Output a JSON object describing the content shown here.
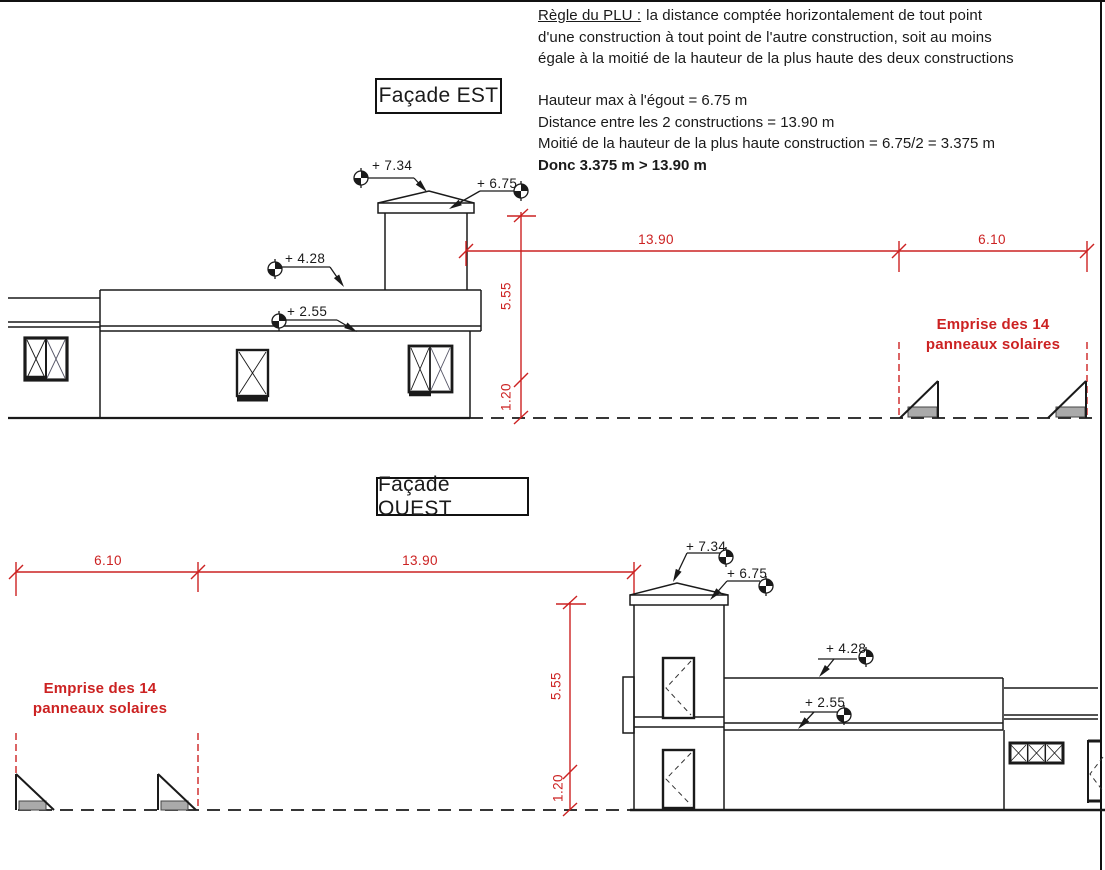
{
  "note": {
    "heading": "Règle du PLU :",
    "para_line1": "la distance comptée horizontalement de tout point",
    "para_line2": "d'une construction à tout point de l'autre construction, soit au moins",
    "para_line3": "égale à la moitié de la hauteur de la plus haute des deux constructions",
    "stat_line1": "Hauteur max à l'égout = 6.75 m",
    "stat_line2": "Distance entre les 2 constructions = 13.90 m",
    "stat_line3": "Moitié de la hauteur de la plus haute construction = 6.75/2 = 3.375 m",
    "conclusion": "Donc 3.375 m > 13.90 m"
  },
  "facade_est": {
    "title": "Façade EST",
    "level_734": "+ 7.34",
    "level_675": "+ 6.75",
    "level_428": "+ 4.28",
    "level_255": "+ 2.55",
    "dim_1390": "13.90",
    "dim_610": "6.10",
    "dim_555": "5.55",
    "dim_120": "1.20",
    "solar_line1": "Emprise des 14",
    "solar_line2": "panneaux solaires"
  },
  "facade_ouest": {
    "title": "Façade OUEST",
    "level_734": "+ 7.34",
    "level_675": "+ 6.75",
    "level_428": "+ 4.28",
    "level_255": "+ 2.55",
    "dim_1390": "13.90",
    "dim_610": "6.10",
    "dim_555": "5.55",
    "dim_120": "1.20",
    "solar_line1": "Emprise des 14",
    "solar_line2": "panneaux solaires"
  },
  "colors": {
    "line_black": "#1a1a1a",
    "dimension_red": "#cc2222",
    "solar_pad_gray": "#aaaaaa"
  }
}
